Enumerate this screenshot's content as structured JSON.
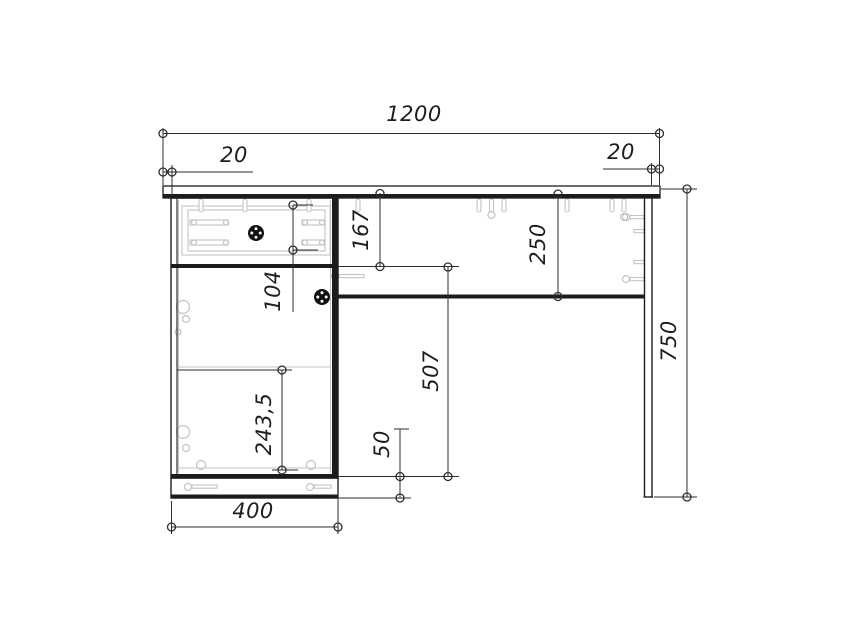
{
  "drawing": {
    "kind": "furniture-assembly-front-view",
    "dim_labels": {
      "overall_width": "1200",
      "left_overhang": "20",
      "right_overhang": "20",
      "overall_height": "750",
      "top_section": "167",
      "drawer_pitch": "104",
      "apron_height": "250",
      "kneehole_height": "507",
      "lower_section": "243,5",
      "plinth_height": "50",
      "pedestal_width": "400"
    },
    "colors": {
      "background": "#ffffff",
      "main_line": "#1c1c1c",
      "dimension_line": "#2e2e2e",
      "detail_line": "#c3c3c3",
      "cam_lock": "#111111"
    }
  }
}
